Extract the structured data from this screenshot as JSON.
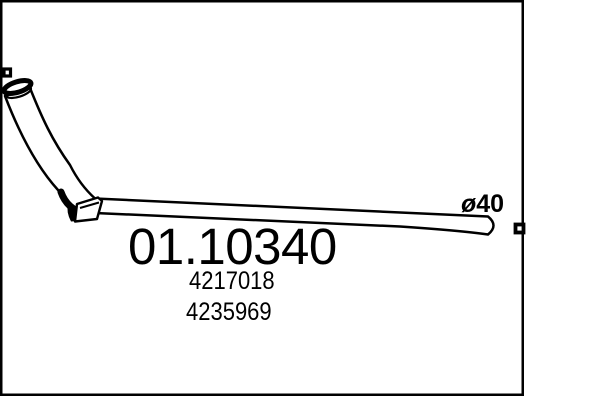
{
  "part_drawing": {
    "part_number": "01.10340",
    "reference_numbers": [
      "4217018",
      "4235969"
    ],
    "diameter_label": "ø40",
    "colors": {
      "line": "#000000",
      "background": "#ffffff"
    }
  }
}
